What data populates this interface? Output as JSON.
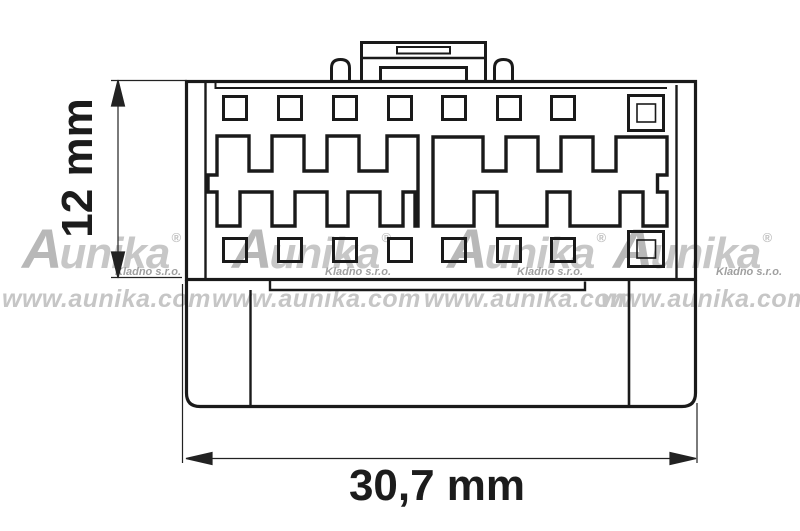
{
  "dimensions": {
    "height": "12 mm",
    "width": "30,7 mm"
  },
  "watermark": {
    "brand_initial": "A",
    "brand_rest": "unika",
    "registered_mark": "®",
    "company": "Kladno s.r.o.",
    "website": "www.aunika.com",
    "repeat_count": 4
  },
  "connector": {
    "pin_squares_top_row": 7,
    "pin_squares_bottom_row": 7,
    "keyed_double_pins": 2,
    "comb_cavity_groups": 2
  },
  "colors": {
    "line": "#1a1a1a",
    "dimension_line": "#222222",
    "watermark_logo": "#b8b8b8",
    "watermark_text": "#c6c6c6",
    "watermark_company": "#9f9f9f",
    "background": "#ffffff"
  }
}
